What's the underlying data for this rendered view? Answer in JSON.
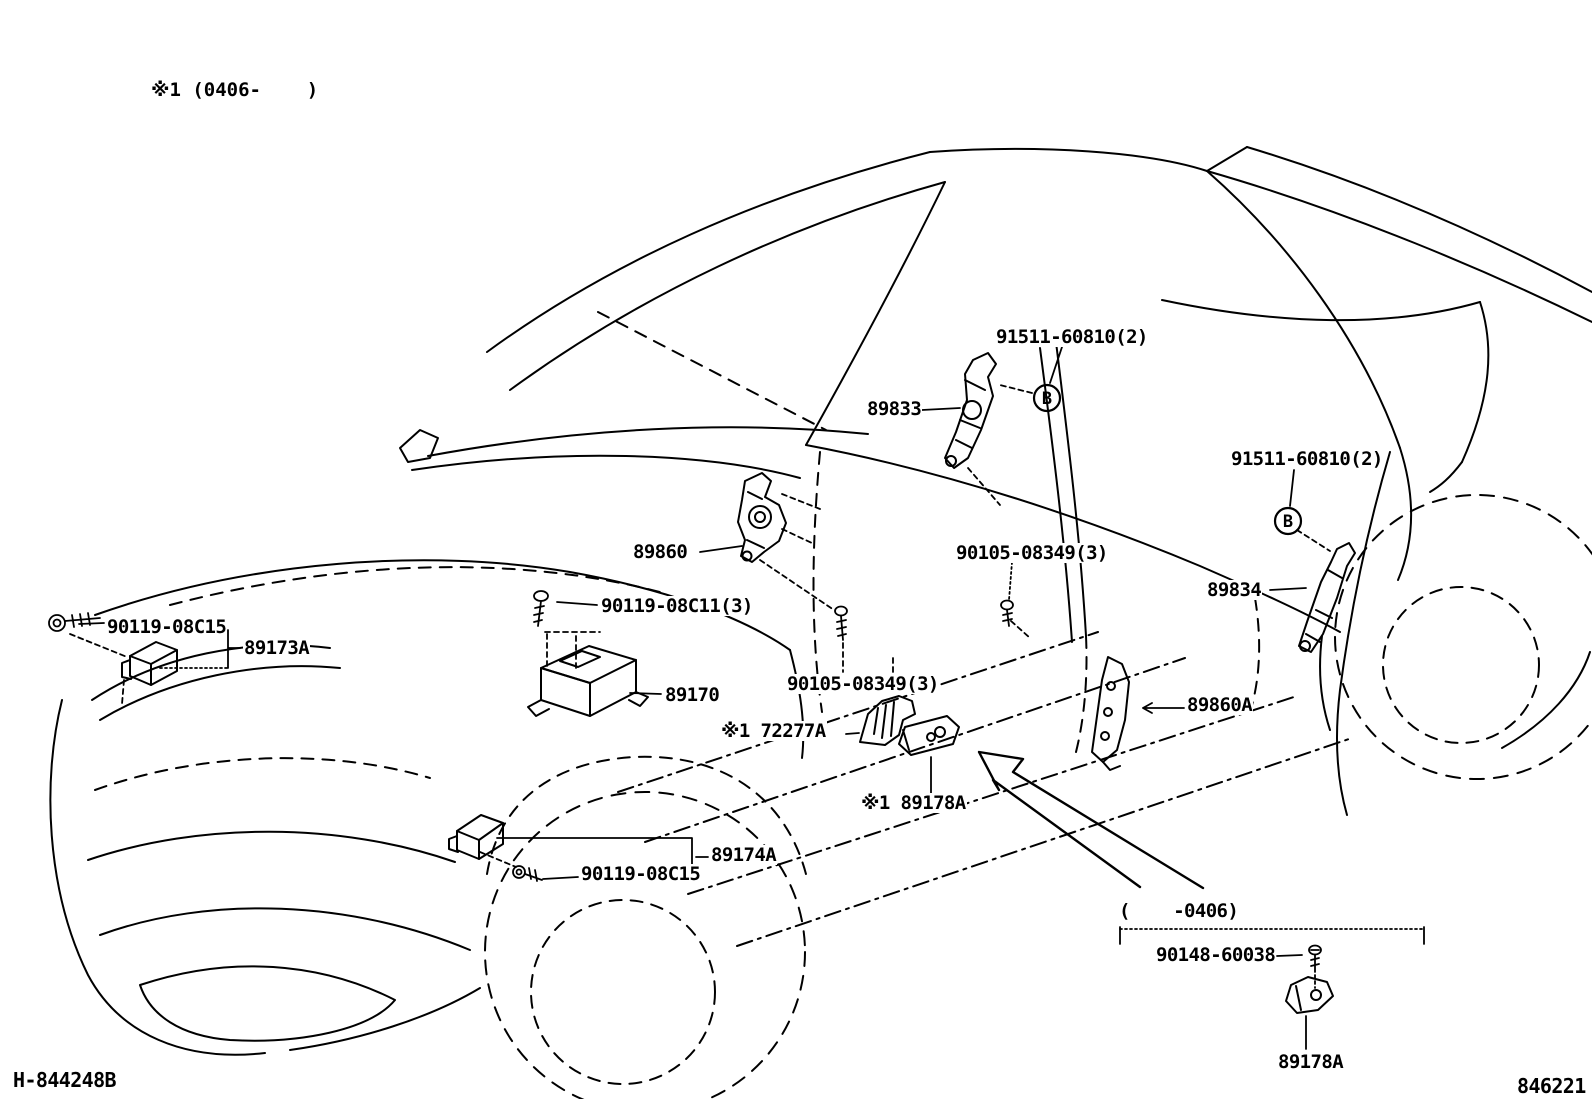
{
  "diagram": {
    "note": "※1 (0406-    )",
    "range_note": "(    -0406)",
    "marker_b": "B",
    "footer_left": "H-844248B",
    "footer_right": "846221",
    "colors": {
      "ink": "#000000",
      "background": "#ffffff"
    },
    "labels": {
      "part_91511_top": "91511-60810(2)",
      "part_89833": "89833",
      "part_91511_right": "91511-60810(2)",
      "part_89834": "89834",
      "part_89860": "89860",
      "part_90119_08c11": "90119-08C11(3)",
      "part_90119_08c15_front": "90119-08C15",
      "part_89173a": "89173A",
      "part_89170": "89170",
      "part_90105_08349_upper": "90105-08349(3)",
      "part_90105_08349_lower": "90105-08349(3)",
      "part_72277a": "※1 72277A",
      "part_89178a_side": "※1 89178A",
      "part_89174a": "89174A",
      "part_90119_08c15_lower": "90119-08C15",
      "part_89860a": "89860A",
      "part_90148_60038": "90148-60038",
      "part_89178a_front": "89178A"
    }
  }
}
